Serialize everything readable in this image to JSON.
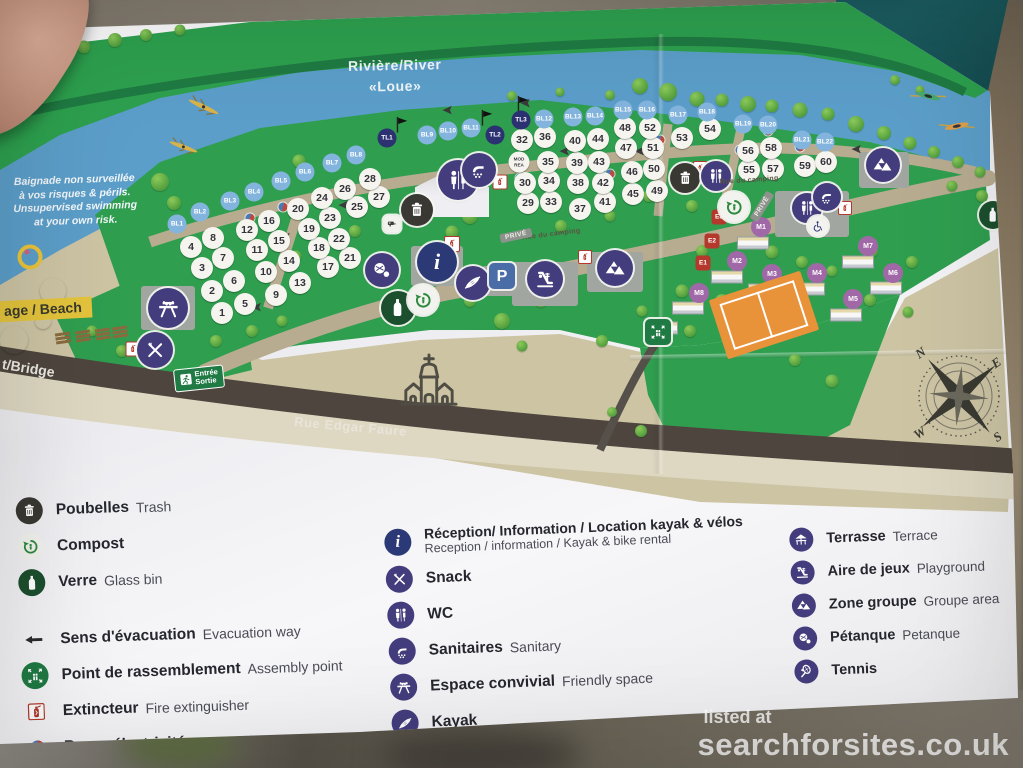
{
  "map": {
    "river_label_line1": "Rivière/River",
    "river_label_line2": "«Loue»",
    "swim_notice": [
      "Baignade non surveillée",
      "à vos risques & périls.",
      "Unsupervised swimming",
      "at your own risk."
    ],
    "beach_label": "age / Beach",
    "bridge_label": "t/Bridge",
    "entrance_sign": [
      "Entrée",
      "Sortie"
    ],
    "road_label_main": "Rue Edgar Faure",
    "road_label_camping": "Rue du camping",
    "prive_sign": "PRIVÉ",
    "special_pitch_line1": "MOD",
    "special_pitch_line2": "REA",
    "info_glyph": "i",
    "parking_glyph": "P",
    "pitch_numbers": [
      "1",
      "2",
      "3",
      "4",
      "5",
      "6",
      "7",
      "8",
      "9",
      "10",
      "11",
      "12",
      "13",
      "14",
      "15",
      "16",
      "17",
      "18",
      "19",
      "20",
      "21",
      "22",
      "23",
      "24",
      "25",
      "26",
      "27",
      "28",
      "29",
      "30",
      "32",
      "33",
      "34",
      "35",
      "36",
      "37",
      "38",
      "39",
      "40",
      "41",
      "42",
      "43",
      "44",
      "45",
      "46",
      "47",
      "48",
      "49",
      "50",
      "51",
      "52",
      "53",
      "54",
      "55",
      "56",
      "57",
      "58",
      "59",
      "60"
    ],
    "bl_labels": [
      "BL1",
      "BL2",
      "BL3",
      "BL4",
      "BL5",
      "BL6",
      "BL7",
      "BL8",
      "BL9",
      "BL10",
      "BL11",
      "BL12",
      "BL13",
      "BL14",
      "BL15",
      "BL16",
      "BL17",
      "BL18",
      "BL19",
      "BL20",
      "BL21",
      "BL22"
    ],
    "tl_labels": [
      "TL1",
      "TL2",
      "TL3"
    ],
    "m_labels": [
      "M1",
      "M2",
      "M3",
      "M4",
      "M5",
      "M6",
      "M7",
      "M8"
    ],
    "e_labels": [
      "E1",
      "E2",
      "E3"
    ],
    "compass": {
      "n": "N",
      "e": "E",
      "s": "S",
      "w": "W"
    }
  },
  "legend": {
    "left": [
      {
        "fr": "Poubelles",
        "en": "Trash"
      },
      {
        "fr": "Compost",
        "en": ""
      },
      {
        "fr": "Verre",
        "en": "Glass bin"
      },
      {
        "fr": "Sens d'évacuation",
        "en": "Evacuation way"
      },
      {
        "fr": "Point de rassemblement",
        "en": "Assembly point"
      },
      {
        "fr": "Extincteur",
        "en": "Fire extinguisher"
      },
      {
        "fr": "Borne électricité",
        "en": "power point"
      }
    ],
    "middle": [
      {
        "fr": "Réception/ Information / Location kayak & vélos",
        "en": "Reception / information / Kayak & bike rental"
      },
      {
        "fr": "Snack",
        "en": ""
      },
      {
        "fr": "WC",
        "en": ""
      },
      {
        "fr": "Sanitaires",
        "en": "Sanitary"
      },
      {
        "fr": "Espace convivial",
        "en": "Friendly space"
      },
      {
        "fr": "Kayak",
        "en": ""
      }
    ],
    "right": [
      {
        "fr": "Terrasse",
        "en": "Terrace"
      },
      {
        "fr": "Aire de jeux",
        "en": "Playground"
      },
      {
        "fr": "Zone groupe",
        "en": "Groupe area"
      },
      {
        "fr": "Pétanque",
        "en": "Petanque"
      },
      {
        "fr": "Tennis",
        "en": ""
      }
    ]
  },
  "watermark": {
    "line1": "listed at",
    "line2": "searchforsites.co.uk"
  },
  "colors": {
    "river": "#5b9ec9",
    "grass": "#2f9e4f",
    "sand": "#cdc4a4",
    "road_dark": "#4e463e",
    "path_tan": "#b7ac90",
    "accent_purple": "#443d7d",
    "info_navy": "#2c3977",
    "bl_blue": "#82b4dd",
    "tl_navy": "#2c3172",
    "m_purple": "#a168a8",
    "e_red": "#b4382c",
    "tennis_orange": "#e8923a",
    "legend_green": "#1f7a43",
    "beach_label_yellow": "#e4c43c"
  }
}
